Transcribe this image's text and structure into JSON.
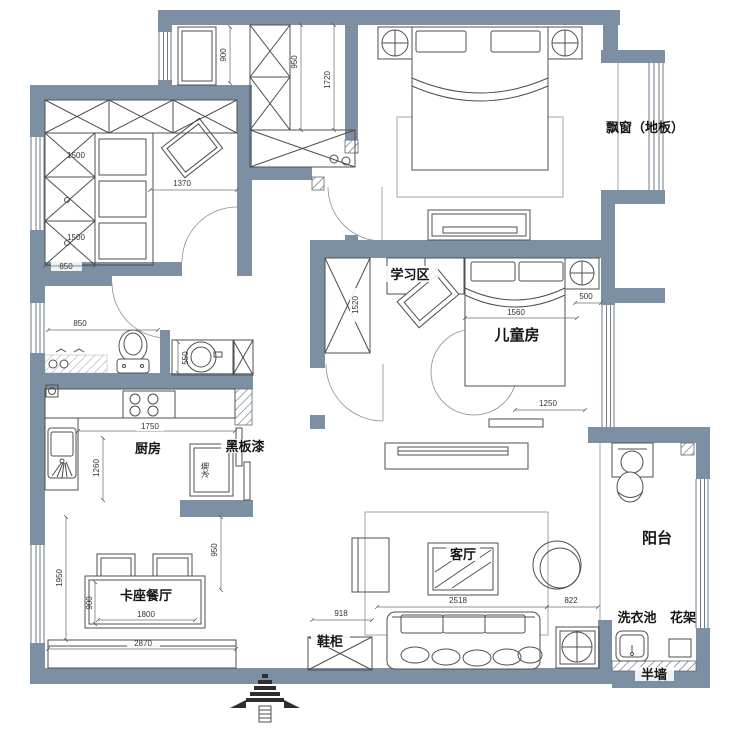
{
  "plan": {
    "labels": {
      "bay_window": "飘窗（地板）",
      "study_area": "学习区",
      "kids_room": "儿童房",
      "kitchen": "厨房",
      "blackboard_paint": "黑板漆",
      "fridge": "冰箱",
      "dining_booth": "卡座餐厅",
      "living_room": "客厅",
      "balcony": "阳台",
      "shoe_cabinet": "鞋柜",
      "laundry_sink": "洗衣池",
      "flower_rack": "花架",
      "half_wall": "半墙"
    },
    "dimensions": {
      "entry_depth": "900",
      "entry_cab": "950",
      "entry_hall": "1720",
      "wardrobe_a": "1500",
      "wardrobe_b": "1500",
      "closet_width": "1370",
      "closet_door": "850",
      "kids_wardrobe": "1520",
      "kids_bed_width": "1560",
      "bed_nook": "500",
      "kids_tv_wall": "1250",
      "shower": "850",
      "basin": "550",
      "counter": "1750",
      "kitchen_depth": "1260",
      "dining_wall": "1950",
      "dining_gap": "950",
      "table_depth": "900",
      "table_width": "1800",
      "bench": "2870",
      "shoe_cab": "918",
      "sofa": "2518",
      "sofa_gap": "822"
    },
    "colors": {
      "wall": "#7d90a3",
      "furniture_line": "#4f4f4f",
      "dimension_text": "#333333",
      "label_text": "#151515"
    }
  }
}
